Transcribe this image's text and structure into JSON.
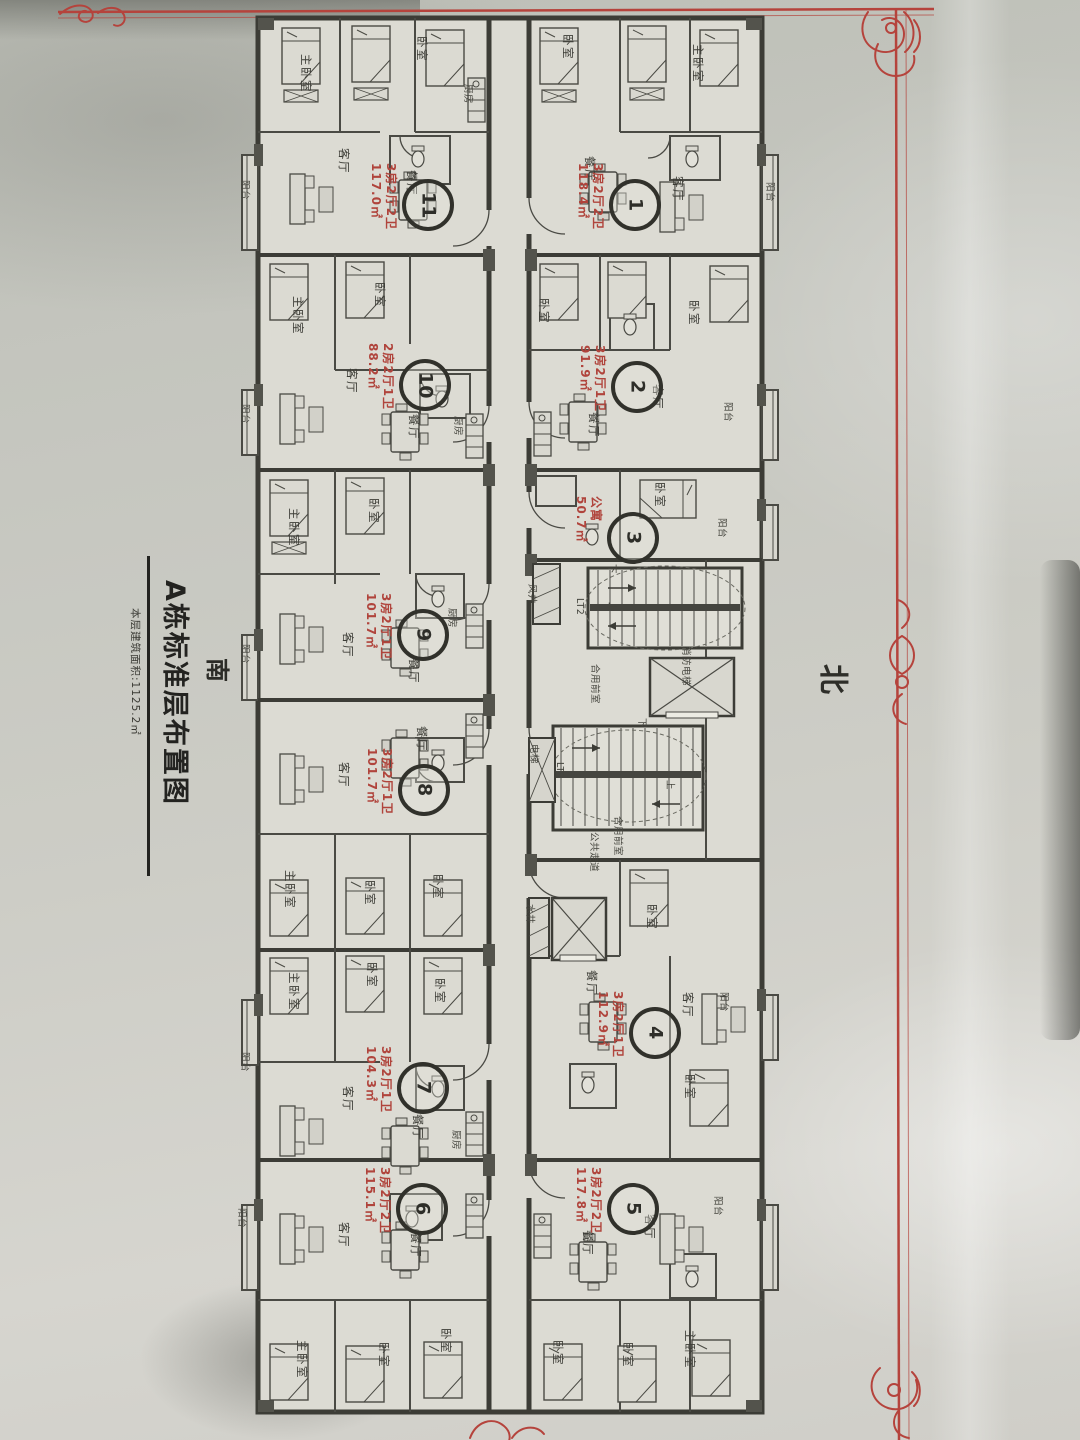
{
  "document": {
    "compass_south": "南",
    "title": "A栋标准层布置图",
    "subtitle": "本层建筑面积:1125.2㎡",
    "compass_north": "北"
  },
  "units": [
    {
      "number": "1",
      "type": "3房2厅2卫",
      "area": "118.4㎡"
    },
    {
      "number": "2",
      "type": "3房2厅1卫",
      "area": "91.9㎡"
    },
    {
      "number": "3",
      "type": "公寓",
      "area": "50.7㎡"
    },
    {
      "number": "4",
      "type": "3房2厅1卫",
      "area": "112.9㎡"
    },
    {
      "number": "5",
      "type": "3房2厅2卫",
      "area": "117.8㎡"
    },
    {
      "number": "6",
      "type": "3房2厅2卫",
      "area": "115.1㎡"
    },
    {
      "number": "7",
      "type": "3房2厅1卫",
      "area": "104.3㎡"
    },
    {
      "number": "8",
      "type": "3房2厅1卫",
      "area": "101.7㎡"
    },
    {
      "number": "9",
      "type": "3房2厅1卫",
      "area": "101.7㎡"
    },
    {
      "number": "10",
      "type": "2房2厅1卫",
      "area": "88.2㎡"
    },
    {
      "number": "11",
      "type": "3房2厅2卫",
      "area": "117.0㎡"
    }
  ],
  "rooms": {
    "master_bedroom": "主卧室",
    "bedroom": "卧室",
    "living_room": "客厅",
    "dining_room": "餐厅",
    "kitchen": "厨房",
    "balcony": "阳台"
  },
  "core": {
    "stair_1": "LT1",
    "stair_2": "LT2",
    "elevator": "电梯",
    "fire_elevator": "消防电梯",
    "shared_lobby": "合用前室",
    "public_corridor": "公共走道",
    "water_shaft": "水井",
    "wind_shaft": "风井",
    "up": "上",
    "down": "下"
  },
  "colors": {
    "annotation_red": "#b0443c",
    "border_red": "#b5433c",
    "ink": "#42423c"
  }
}
